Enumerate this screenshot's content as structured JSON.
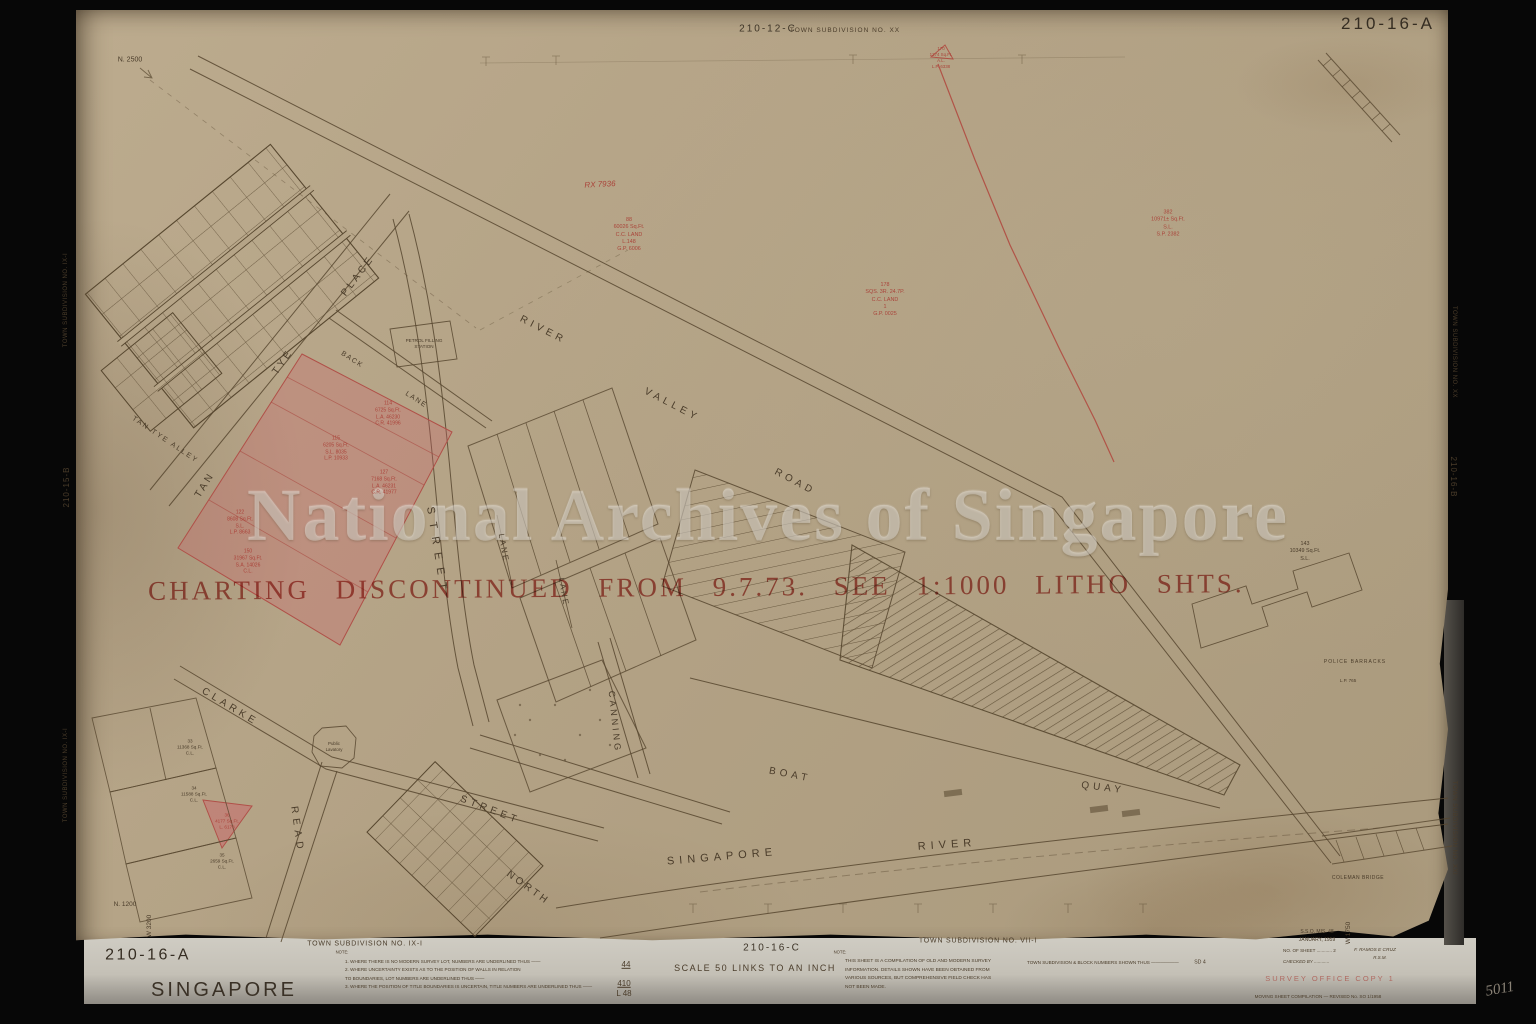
{
  "meta": {
    "archive_watermark": "National Archives of Singapore",
    "stamp": "CHARTING DISCONTINUED FROM 9.7.73. SEE 1:1000 LITHO SHTS."
  },
  "header": {
    "ref": "210-12-C",
    "subdivision": "TOWN SUBDIVISION NO. XX",
    "sheet_no": "210-16-A"
  },
  "edges": {
    "left_top": "TOWN SUBDIVISION NO. IX-I",
    "left_mid": "210-15-B",
    "left_bottom": "TOWN SUBDIVISION NO. IX-I",
    "right_top": "TOWN SUBDIVISION NO. XX",
    "right_mid": "210-16-B",
    "right_bottom": "TOWN SUBDIVISION NO. XXI"
  },
  "corners": {
    "n_top": "N. 2500",
    "n_bottom": "N. 1200",
    "w_left": "W 3200",
    "w_right": "W 1750"
  },
  "streets": {
    "river": "RIVER",
    "valley": "VALLEY",
    "road": "ROAD",
    "tan": "TAN",
    "tye": "TYE",
    "place": "PLACE",
    "alley": "TAN TYE ALLEY",
    "back": "BACK",
    "back_lane": "LANE",
    "street_v": "STREET",
    "clarke": "CLARKE",
    "street_d": "STREET",
    "read": "READ",
    "north": "NORTH",
    "canning": "CANNING",
    "lane1": "LANE",
    "lane2": "LANE",
    "boat": "BOAT",
    "quay": "QUAY",
    "singapore": "SINGAPORE",
    "river2": "RIVER"
  },
  "buildings": {
    "petrol": [
      "PETROL FILLING",
      "STATION"
    ],
    "lavatory": [
      "Public",
      "Lavatory"
    ],
    "police": "POLICE BARRACKS",
    "police_ref": "L.P. 765",
    "coleman": "COLEMAN BRIDGE"
  },
  "annotations": {
    "rx": "RX 7936",
    "a170": [
      "170",
      "1274 Sq.Ft.",
      "A.L.",
      "L.P. 6338"
    ],
    "a88": [
      "88",
      "60026 Sq.Ft.",
      "C.C. LAND",
      "L.148",
      "G.P. 6006"
    ],
    "a178": [
      "178",
      "SQS. 3R. 24.7P.",
      "C.C. LAND",
      "1",
      "G.P. 0025"
    ],
    "a382": [
      "382",
      "10971± Sq.Ft.",
      "S.L.",
      "S.P. 2382"
    ],
    "a143": [
      "143",
      "10349 Sq.Ft.",
      "S.L."
    ],
    "p114": [
      "114",
      "6725 Sq.Ft.",
      "L.A. 46230",
      "C.R. 41996"
    ],
    "p115": [
      "115",
      "6205 Sq.Ft.",
      "S.L. 8035",
      "L.P. 10933"
    ],
    "p127": [
      "127",
      "7168 Sq.Ft.",
      "L.A. 46231",
      "C.R. 41977"
    ],
    "p122": [
      "122",
      "8608 Sq.Ft.",
      "S.L.",
      "L.P. 8663"
    ],
    "p150": [
      "150",
      "31967 Sq.Ft.",
      "S.A. 14026",
      "C.L."
    ],
    "p36": [
      "36",
      "4177 Sq.Ft.",
      "L. 6178"
    ],
    "l33": [
      "33",
      "11368 Sq.Ft.",
      "C.L."
    ],
    "l34": [
      "34",
      "11588 Sq.Ft.",
      "C.L."
    ],
    "l35": [
      "35",
      "2659 Sq.Ft.",
      "C.L."
    ]
  },
  "footer": {
    "sheet_no": "210-16-A",
    "city": "SINGAPORE",
    "ts_left": "TOWN SUBDIVISION NO. IX-I",
    "note_label_left": "NOTE:",
    "left_notes": [
      "1.   WHERE THERE IS NO MODERN SURVEY LOT, NUMBERS ARE UNDERLINED THUS ——",
      "2.   WHERE UNCERTAINTY EXISTS AS TO THE POSITION OF WALLS IN RELATION",
      "      TO BOUNDARIES, LOT NUMBERS ARE UNDERLINED THUS ——",
      "3.   WHERE THE POSITION OF TITLE BOUNDARIES IS UNCERTAIN, TITLE NUMBERS ARE UNDERLINED THUS ——"
    ],
    "frac_top": "44",
    "frac_mid": "410",
    "frac_bot": "L 48",
    "ref_center": "210-16-C",
    "scale": "SCALE 50 LINKS TO AN INCH",
    "note_label_right": "NOTE:",
    "right_notes": [
      "THIS SHEET IS A COMPILATION OF OLD AND MODERN SURVEY",
      "INFORMATION.  DETAILS SHOWN HAVE BEEN OBTAINED FROM",
      "VARIOUS SOURCES, BUT COMPREHENSIVE FIELD CHECK HAS",
      "NOT BEEN MADE."
    ],
    "ts_right": "TOWN SUBDIVISION NO. VII-I",
    "block_note": "TOWN SUBDIVISION & BLOCK NUMBERS SHOWN THUS ——————",
    "block_note_value": "SD 4",
    "office_ref": "S.S.O. MIS. 48",
    "office_date": "JANUARY, 1959",
    "sheet_line": "NO. OF SHEET ............ 2",
    "traced_by": "F. RAMOS E CRUZ",
    "traced_title": "R.S.M.",
    "checked_line": "CHECKED BY ............",
    "survey_copy": "SURVEY OFFICE COPY 1",
    "compilation": "MOVING SHEET COMPILATION — REVISED No. SO 1/1958",
    "pencil": "5011"
  },
  "colors": {
    "paper": "#b3a285",
    "ink": "#57472f",
    "red": "#b0453c",
    "pink": "rgba(205,95,105,0.30)"
  }
}
